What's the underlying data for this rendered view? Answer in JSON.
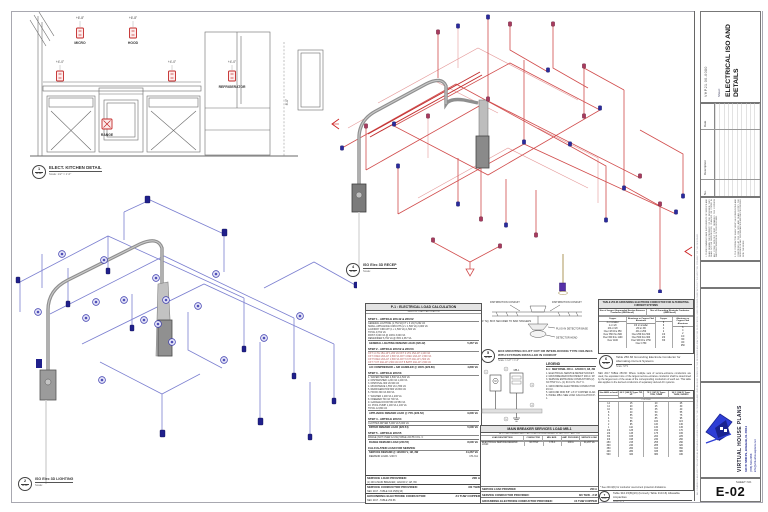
{
  "sheet": {
    "project_code": "VHP21.00-0080",
    "sheet_label": "Sheet:",
    "title": "ELECTRICAL ISO AND DETAILS",
    "sheet_no_label": "SHEET NO.",
    "sheet_no": "E-02"
  },
  "title_block": {
    "strip_note": "ALL DRAWINGS AND WRITTEN MATERIAL APPEARING HEREIN CONSTITUTE THE ORIGINAL AND UNPUBLISHED WORK OF THE DESIGNER AND MAY NOT BE DUPLICATED, USED OR DISCLOSED WITHOUT THE WRITTEN CONSENT OF THE DESIGNER.",
    "revision": {
      "no": "No.",
      "description": "Description",
      "date": "Date"
    },
    "disclaimer1": "1. THESE DRAWINGS ARE INSTRUMENTS OF SERVICE AND SHALL REMAIN THE PROPERTY OF THE DESIGNER. THEY SHALL NOT BE REPRODUCED, CHANGED OR COPIED IN ANY FORM WITHOUT FIRST OBTAINING THE EXPRESS WRITTEN PERMISSION OF THE DESIGNER.",
    "disclaimer2": "2. THE CONTRACTOR SHALL VERIFY ALL DIMENSIONS AND CONDITIONS AT THE JOB SITE AND SHALL NOTIFY THE DESIGNER OF ANY DISCREPANCIES BEFORE PROCEEDING WITH THE WORK.",
    "logo": {
      "company": "VIRTUAL HOUSE PLANS",
      "address": "340 W 72ND PL, HIALEAH, FL 33014",
      "phone": "(786) 530-2958",
      "email": "info@virtualhouseplans.net"
    }
  },
  "views": {
    "kitchen": {
      "ref": "1",
      "sheet": "E-02",
      "title": "ELECT. KITCHEN DETAIL",
      "scale": "Scale: 1/2\" = 1'-0\"",
      "labels": {
        "micro": "MICRO",
        "hood": "HOOD",
        "refrigerator": "REFRIGERATOR",
        "range": "RANGE"
      },
      "dims": {
        "d1": "+6'-8\"",
        "d2": "+6'-8\"",
        "d3": "+4'-0\"",
        "d4": "+4'-0\"",
        "d5": "+4'-0\"",
        "height": "8'-0\""
      }
    },
    "recep_iso": {
      "ref": "4",
      "sheet": "E-02",
      "title": "ISO Elec 3D RECEP",
      "scale": "Scale:"
    },
    "lighting_iso": {
      "ref": "2",
      "sheet": "E-02",
      "title": "ISO Elec 3D LIGHTING",
      "scale": "Scale:"
    },
    "detector": {
      "ref": "5",
      "sheet": "E-02",
      "title": "BOX MOUNTING IN LIFT OUT OR INTERLOCKING TYPE CEILINGS WITH SYSTEMS INSTALLED IN CONDUIT",
      "scale": "Scale: 1 1/2\" = 1'-0\"",
      "labels": {
        "dist1": "DISTRIBUTION CONDUIT",
        "dist2": "DISTRIBUTION CONDUIT",
        "base": "PLUG-IN DETECTOR BASE",
        "head": "DETECTOR HEAD",
        "note": "4\" SQ. BOX SECURED TO BAR HANGERS"
      }
    },
    "grounding_caption": {
      "ref": "6",
      "sheet": "E-02",
      "title": "Table 250.66 Grounding Electrode Conductor for Alternating-Current Systems",
      "scale": "Scale: NTS"
    },
    "ampacity_caption": {
      "ref": "7",
      "sheet": "E-02",
      "title": "Table 310.15(B)(16) (formerly Table 310.16) Allowable Ampacities",
      "scale": "Scale: NTS"
    }
  },
  "load_calc": {
    "title": "P-1 : ELECTRICAL LOAD CALCULATION",
    "subtitle": "SERVICE LOAD CALCULATION",
    "step1_h": "STEP 1 - ARTICLE 220.42 & 220.52",
    "step1": "GENERAL LIGHTING (1,754 SQ FT x 3 VA)  5,262 VA\nSMALL APPLIANCE CIRCUITS (2 x 1,500 VA)  3,000 VA\nLAUNDRY CIRCUIT (1 x 1,500 VA)  1,500 VA\nTOTAL  9,762 VA\nFIRST 3,000 VA @ 100%  3,000 VA\nREMAINDER 6,762 VA @ 35%  2,367 VA",
    "step1_total_label": "GENERAL LIGHTING DEMAND LOAD (220.42)",
    "step1_total_value": "5,367 VA",
    "step2_h": "STEP 2 - ARTICLE 220.52 & 220.53",
    "step2": "CKT 1  LTG  15A-1P  1,200 VA      CKT 2  LTG  15A-1P  1,100 VA\nCKT 3  REC  20A-1P  1,500 VA      CKT 4  REC  20A-1P  1,500 VA\nCKT 5  REC  20A-1P  1,500 VA      CKT 6  KIT  20A-1P  1,500 VA\nCKT 7  KIT  20A-1P  1,500 VA      CKT 8  BATH 20A-1P  1,500 VA",
    "step2_total_label": "A/C COMPRESSOR + AIR HANDLER @ 100% (220.60)",
    "step2_total_value": "4,800 VA",
    "step3_h": "STEP 3 - ARTICLE 220.53",
    "step3": "1. WATER HEATER  4,500 VA  4,500 VA\n2. DISHWASHER  1,200 VA  1,200 VA\n3. DISPOSAL  900 VA  900 VA\n4. MICROWAVE  1,550 VA  1,550 VA\n5. REFRIGERATOR  800 VA  800 VA\n6. HOOD  300 VA  300 VA\n7. WASHER  1,200 VA  1,200 VA\n8. FREEZER  700 VA  700 VA\n9. GARAGE DOOR  550 VA  550 VA\n10. POOL PUMP  1,100 VA  1,100 VA\nTOTAL  12,800 VA",
    "step3_total_label": "APPLIANCE DEMAND LOAD @ 75% (220.53)",
    "step3_total_value": "9,600 VA",
    "step4_h": "STEP 4 - ARTICLE 220.54",
    "step4": "CLOTHES DRYER  5,000 VA  5,000 VA",
    "step4_total_label": "DRYER DEMAND LOAD (220.54)",
    "step4_total_value": "5,000 VA",
    "step5_h": "STEP 5 - ARTICLE 220.55",
    "step5": "RANGE (NOT OVER 12 kW)  TABLE 220.55 COL. C",
    "step5_total_label": "RANGE DEMAND LOAD (220.55)",
    "step5_total_value": "8,000 VA",
    "calc_h": "CALCULATED LOAD FOR SERVICE",
    "calc_total_label": "SERVICE DEMAND @ 120/240 V, 1Ø, 3W",
    "calc_total_value": "41,267 VA",
    "amp_label": "DEMAND LOAD / 240 V",
    "amp_value": "171.9 A",
    "service_load_label": "SERVICE LOAD PROVIDED:",
    "service_load_note": "(1) 200 A MAIN BREAKER, 120/240 V, 1Ø, 3W",
    "service_load_value": "200 A",
    "conductor_label": "SERVICE CONDUCTOR PROVIDED:",
    "conductor_note": "NEC 2017 - TABLE 310.15(B)(16)",
    "conductor_value": "3/0 THW",
    "gec_label": "GROUNDING ELECTRODE CONDUCTOR:",
    "gec_note": "NEC 2017 - TABLE 250.66",
    "gec_value": "#4 THW COPPER"
  },
  "mb_table": {
    "title": "MAIN BREAKER SERVICES LOAD MB-1",
    "note": "ALL LOAD DEMAND AND CALCULATION PERFORMED W/ NEC 2017 - ART. 220",
    "headers": [
      "LOAD DESCRIPTION",
      "CONDUCTOR",
      "MIN. BKR.",
      "AMP. PROVIDED",
      "SERVICE LOAD"
    ],
    "row": [
      "ELECTRICAL SERVICE DEMAND LOAD",
      "3/0 THW",
      "175 A",
      "200 A",
      "41,267 VA"
    ],
    "total_label": "SERVICE LOAD PROVIDED",
    "total_value": "200 A",
    "r1_label": "SERVICE CONDUCTOR PROVIDED:",
    "r1_value": "3/0 THW - 2 M",
    "r2_label": "GROUNDING ELECTRODE CONDUCTOR PROVIDED:",
    "r2_value": "#4 THW COPPER"
  },
  "legend": {
    "title": "LEGEND",
    "panel": "E-1 : NEW PANEL 200 A - 120/240 V, 1Ø, 3W",
    "notes": "1. ELECTRICAL SERVICE METER SOCKET.\n2. MAIN BREAKER DISCONNECT 200 A / 2P.\n3. SERVICE ENTRANCE CONDUCTORS (2) 3/0 THW CU + (1) #4 CU N. IN 2\" C.\n4. GROUNDING ELECTRODE CONDUCTOR #4 CU.\n5. GROUND ROD 5/8\" x 8'-0\" COPPER CLAD.\n6. PANEL MB-1 SEE LOAD CALCULATION P-1."
  },
  "riser": {
    "meter": "M",
    "panel": "MB-1"
  },
  "grounding_table": {
    "title": "TABLE 250.66 GROUNDING ELECTRODE CONDUCTOR FOR ALTERNATING-CURRENT SYSTEMS",
    "group1": "Size of Largest Ungrounded Service-Entrance Conductor (AWG/kcmil)",
    "group2": "Size of Grounding Electrode Conductor (AWG/kcmil)",
    "h1": "Copper",
    "h2": "Aluminum or Copper-Clad Aluminum",
    "h3": "Copper",
    "h4": "Aluminum or Copper-Clad Aluminum",
    "col1": "2 or smaller\n1 or 1/0\n2/0 or 3/0\nOver 3/0 thru 350\nOver 350 thru 600\nOver 600 thru 1100\nOver 1100",
    "col2": "1/0 or smaller\n2/0 or 3/0\n4/0 or 250\nOver 250 thru 500\nOver 500 thru 900\nOver 900 thru 1750\nOver 1750",
    "col3": "8\n6\n4\n2\n1/0\n2/0\n3/0",
    "col4": "6\n4\n2\n1/0\n3/0\n4/0\n250",
    "notes": "NEC 2017 TABLE 250.66: Where multiple sets of service-entrance conductors are used, the equivalent size of the largest service-entrance conductor shall be determined by the largest sum of the areas of the corresponding conductors of each set. This table also applies to the derived conductors of separately derived AC systems."
  },
  "ampacity_table": {
    "h_size": "Size AWG or kcmil",
    "h_60": "60°C (140°F) Types TW, UF",
    "h_75": "75°C (167°F) Types THW, THWN",
    "h_90": "90°C (194°F) Types THHN, XHHW-2",
    "subh": "COPPER",
    "col_size": "14\n12\n10\n8\n6\n4\n3\n2\n1\n1/0\n2/0\n3/0\n4/0\n250\n300\n350\n400\n500",
    "col_60": "15\n20\n30\n40\n55\n70\n85\n95\n110\n125\n145\n165\n195\n215\n240\n260\n280\n320",
    "col_75": "20\n25\n35\n50\n65\n85\n100\n115\n130\n150\n175\n200\n230\n255\n285\n310\n335\n380",
    "col_90": "25\n30\n40\n55\n75\n95\n115\n130\n145\n170\n195\n225\n260\n290\n320\n350\n380\n430",
    "footnote": "* See 240.4(D) for conductor overcurrent protection limitations."
  },
  "colors": {
    "wiring_red": "#d14c4c",
    "wiring_blue": "#7b7fd0",
    "node_navy": "#2a2a9e",
    "node_crimson": "#a83a5e",
    "conduit_gray": "#8f8f8f",
    "logo_blue": "#2e3ed6",
    "symbol_red": "#c22828"
  }
}
